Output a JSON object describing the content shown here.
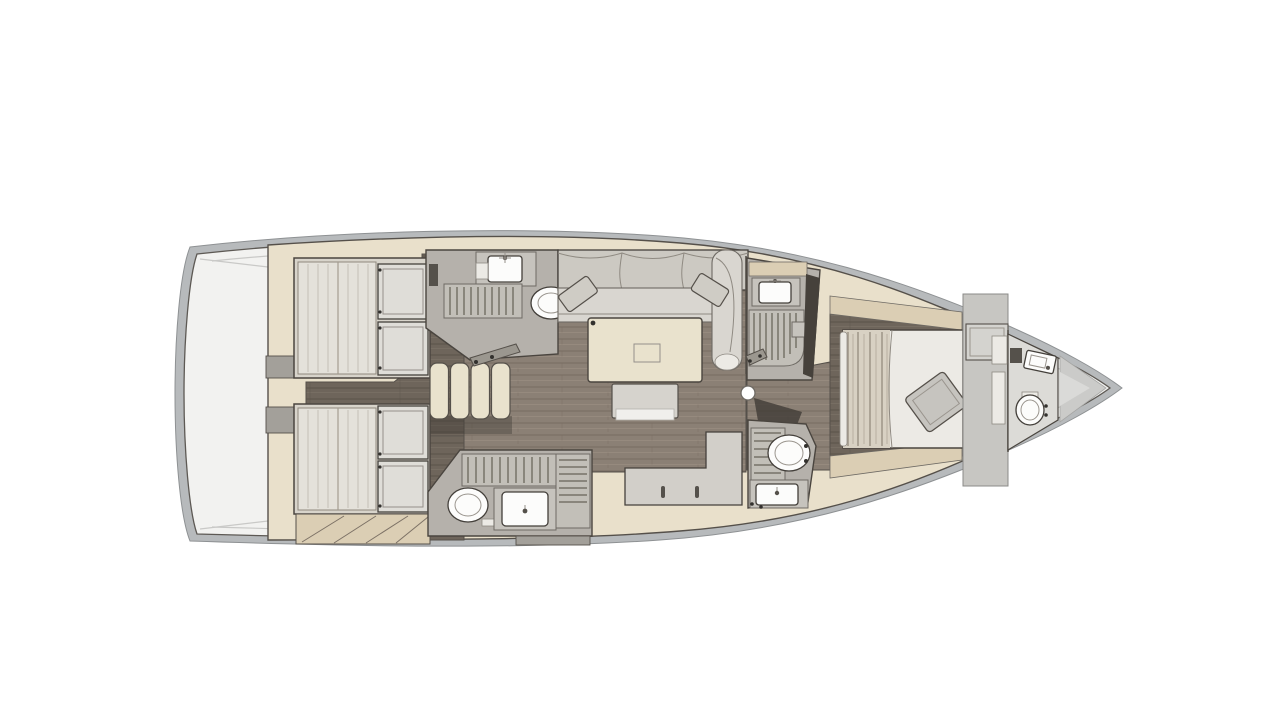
{
  "canvas": {
    "width": 1280,
    "height": 720
  },
  "palette": {
    "page_bg": "#ffffff",
    "hull_rim": "#b7babc",
    "deck": "#f2f2f0",
    "outline": "#4a453f",
    "cream": "#e9e0cb",
    "cream_dark": "#dbceb4",
    "wood_floor": "#8b8075",
    "wood_streak": "#776c61",
    "wood_dark": "#6e655b",
    "wood_dark_streak": "#5b5249",
    "gray_room": "#b5b1ab",
    "gray_counter": "#c6c3bd",
    "grate": "#c2bfb8",
    "grate_slat": "#767269",
    "fixture_white": "#fcfcfb",
    "sofa_back": "#ccc9c2",
    "sofa_seat": "#d9d6d0",
    "cushion": "#cfccc5",
    "table_top": "#e9e2cd",
    "bench": "#d6d3cd",
    "mattress": "#e4e1da",
    "mattress_streak": "#c9c5bb",
    "locker": "#dfddd8",
    "blanket": "#d8d1c3",
    "blanket_streak": "#8a8174",
    "bed_white": "#eceae5",
    "pillow": "#c6c4bf",
    "bulkhead": "#c7c6c2",
    "wardrobe": "#d4d3cf",
    "bow_wedge": "#cbcbc9",
    "bow_wedge_hi": "#dadad8",
    "step_gray": "#a3a09a",
    "galley": "#d2cfc9"
  },
  "regions": [
    {
      "name": "hull"
    },
    {
      "name": "stern-deck"
    },
    {
      "name": "aft-cabin-top"
    },
    {
      "name": "aft-cabin-bottom"
    },
    {
      "name": "companionway-stairs"
    },
    {
      "name": "head-aft-top"
    },
    {
      "name": "head-aft-bottom"
    },
    {
      "name": "salon"
    },
    {
      "name": "galley"
    },
    {
      "name": "shower-room-mid"
    },
    {
      "name": "head-mid-forward"
    },
    {
      "name": "forward-cabin"
    },
    {
      "name": "bow-head"
    },
    {
      "name": "bow"
    }
  ]
}
